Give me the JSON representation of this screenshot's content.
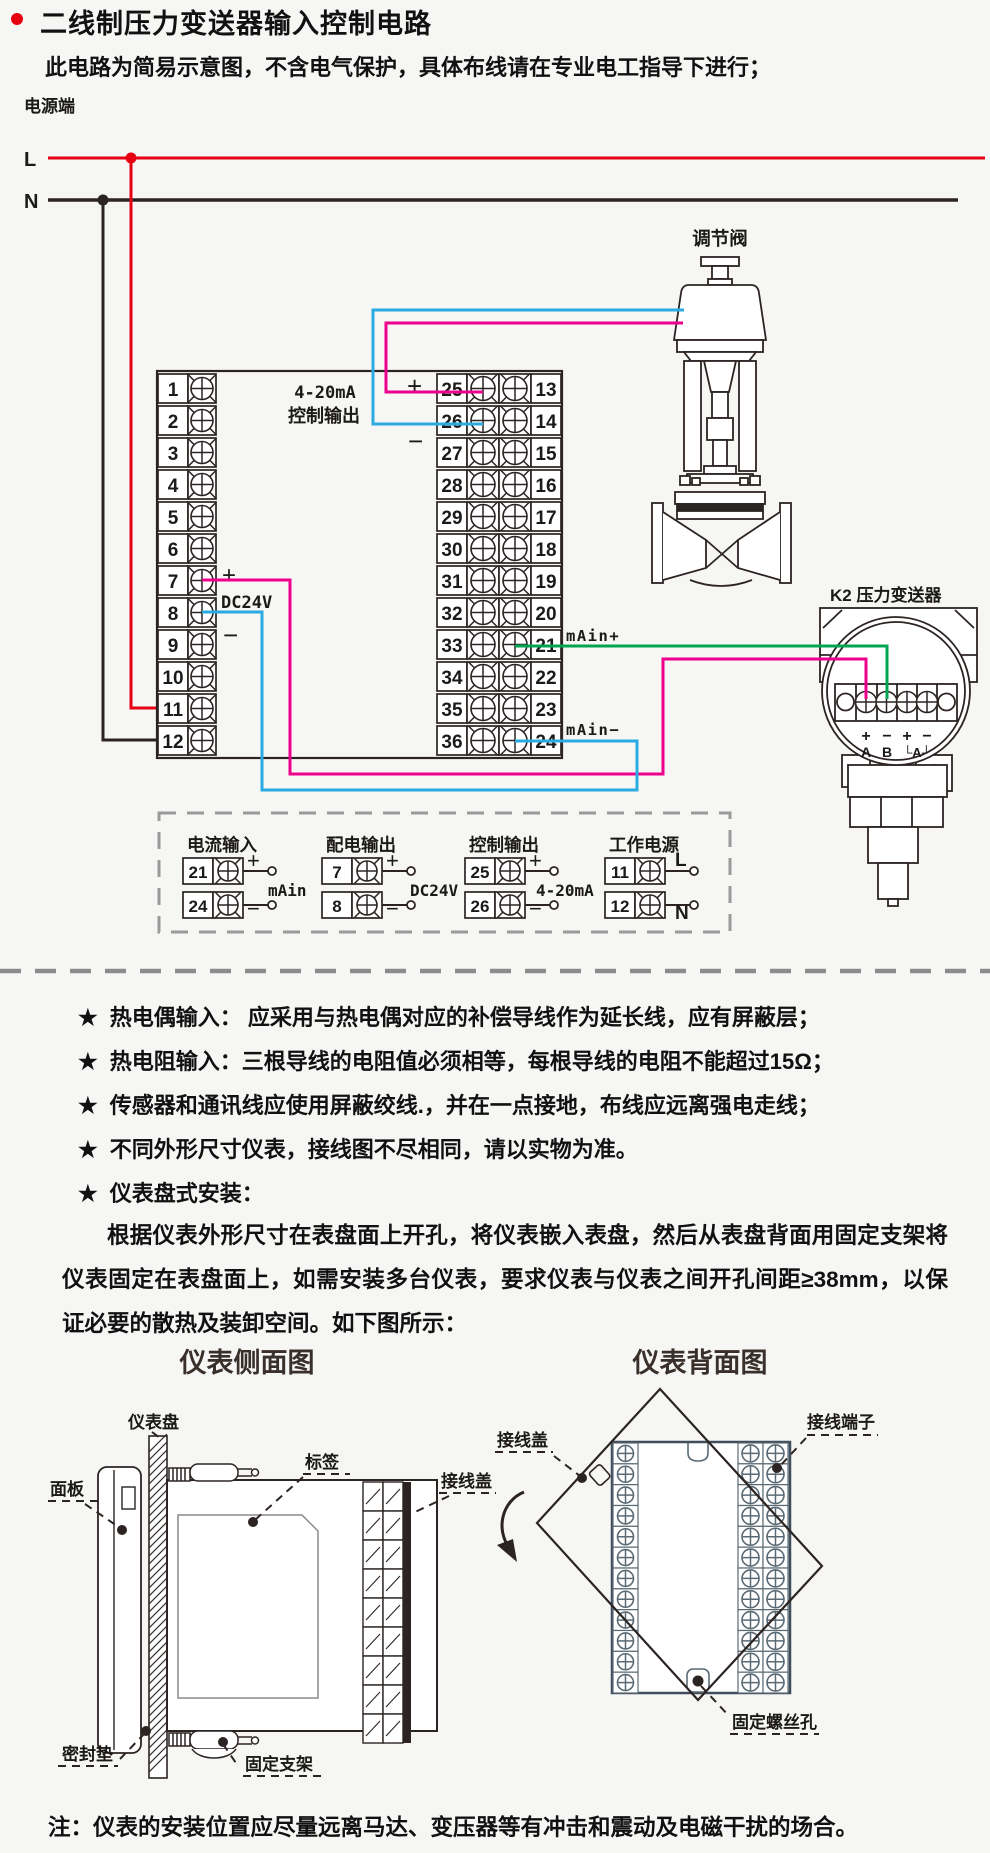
{
  "colors": {
    "line": "#2b2422",
    "red": "#e60012",
    "blue": "#29abe2",
    "magenta": "#ec008c",
    "green": "#00a551",
    "gray_dash": "#8c8c8c",
    "slate": "#3f4e5a",
    "cell_gray": "#5a6a74"
  },
  "header": {
    "title": "二线制压力变送器输入控制电路",
    "subtitle": "此电路为简易示意图，不含电气保护，具体布线请在专业电工指导下进行；"
  },
  "power": {
    "terminal_label": "电源端",
    "live": "L",
    "neutral": "N"
  },
  "instrument": {
    "left_terminals": [
      "1",
      "2",
      "3",
      "4",
      "5",
      "6",
      "7",
      "8",
      "9",
      "10",
      "11",
      "12"
    ],
    "mid_terminals": [
      "25",
      "26",
      "27",
      "28",
      "29",
      "30",
      "31",
      "32",
      "33",
      "34",
      "35",
      "36"
    ],
    "right_terminals": [
      "13",
      "14",
      "15",
      "16",
      "17",
      "18",
      "19",
      "20",
      "21",
      "22",
      "23",
      "24"
    ],
    "control_output_line1": "4-20mA",
    "control_output_line2": "控制输出",
    "plus": "+",
    "minus": "−",
    "dc24v_label": "DC24V",
    "main_plus": "mAin+",
    "main_minus": "mAin−"
  },
  "valve": {
    "label": "调节阀"
  },
  "transmitter": {
    "label": "K2 压力变送器",
    "pin_signs": [
      "+",
      "−",
      "+",
      "−"
    ],
    "pin_names": [
      "A",
      "B",
      "└A┘"
    ]
  },
  "legend": {
    "groups": [
      {
        "title": "电流输入",
        "rows": [
          {
            "no": "21",
            "sign": "+"
          },
          {
            "no": "24",
            "sign": "−"
          }
        ],
        "caption": "mAin"
      },
      {
        "title": "配电输出",
        "rows": [
          {
            "no": "7",
            "sign": "+"
          },
          {
            "no": "8",
            "sign": "−"
          }
        ],
        "caption": "DC24V"
      },
      {
        "title": "控制输出",
        "rows": [
          {
            "no": "25",
            "sign": "+"
          },
          {
            "no": "26",
            "sign": "−"
          }
        ],
        "caption": "4-20mA"
      },
      {
        "title": "工作电源",
        "rows": [
          {
            "no": "11",
            "sign": "L"
          },
          {
            "no": "12",
            "sign": "N"
          }
        ],
        "caption": ""
      }
    ]
  },
  "notes": {
    "star_symbol": "★",
    "stars": [
      "热电偶输入： 应采用与热电偶对应的补偿导线作为延长线，应有屏蔽层；",
      "热电阻输入：三根导线的电阻值必须相等，每根导线的电阻不能超过15Ω；",
      "传感器和通讯线应使用屏蔽绞线.，并在一点接地，布线应远离强电走线；",
      "不同外形尺寸仪表，接线图不尽相同，请以实物为准。",
      "仪表盘式安装："
    ],
    "paragraph": "根据仪表外形尺寸在表盘面上开孔，将仪表嵌入表盘，然后从表盘背面用固定支架将仪表固定在表盘面上，如需安装多台仪表，要求仪表与仪表之间开孔间距≥38mm，以保证必要的散热及装卸空间。如下图所示："
  },
  "side_view": {
    "title": "仪表侧面图",
    "labels": {
      "panel": "仪表盘",
      "front_panel": "面板",
      "tag": "标签",
      "terminal_cover": "接线盖",
      "gasket": "密封垫",
      "bracket": "固定支架"
    }
  },
  "back_view": {
    "title": "仪表背面图",
    "labels": {
      "terminal_cover": "接线盖",
      "terminal": "接线端子",
      "screw_hole": "固定螺丝孔"
    }
  },
  "footnote": "注：仪表的安装位置应尽量远离马达、变压器等有冲击和震动及电磁干扰的场合。"
}
